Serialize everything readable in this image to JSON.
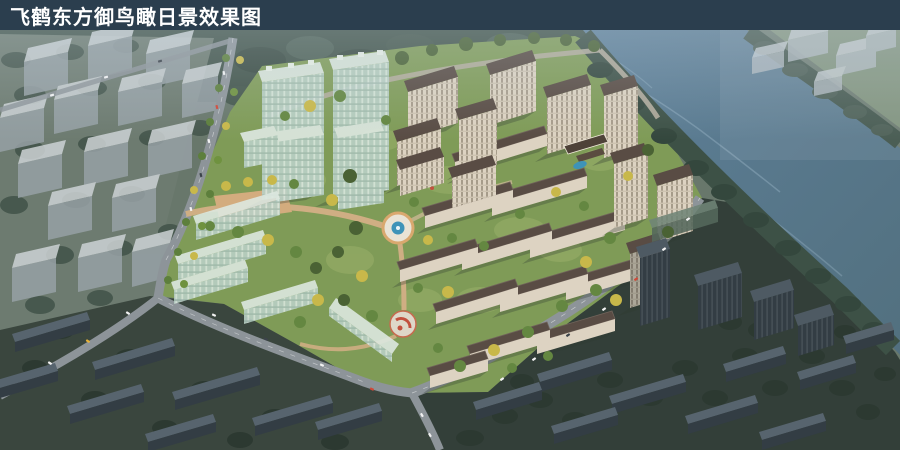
{
  "header": {
    "title": "飞鹤东方御鸟瞰日景效果图"
  },
  "palette": {
    "titlebar": "#2b3e4e",
    "titletext": "#ffffff",
    "water": "#5e8099",
    "waterdeep": "#52707f",
    "bankforest": "#3d5146",
    "farfield": "#7d9078",
    "massing": "#c6cdd1",
    "citybox": "#97a1a6",
    "cityboxtop": "#cdd3d5",
    "cityground": "#6d7b70",
    "forest": "#42544a",
    "lawn": "#7f9b57",
    "lawnlight": "#97ae68",
    "treegreen": "#648741",
    "treedark": "#4a6234",
    "treeyellow": "#c8b84a",
    "wall": "#ddd3c2",
    "roof": "#594c44",
    "glass": "#b9d0c5",
    "glasstop": "#dde8e0",
    "darkwall": "#333d44",
    "darkroof": "#57646e",
    "darkground": "#3a463e",
    "road": "#8d9499",
    "path": "#cfae83",
    "plaza": "#e9e3d5",
    "pool": "#3e93b8",
    "red": "#c2503e"
  }
}
